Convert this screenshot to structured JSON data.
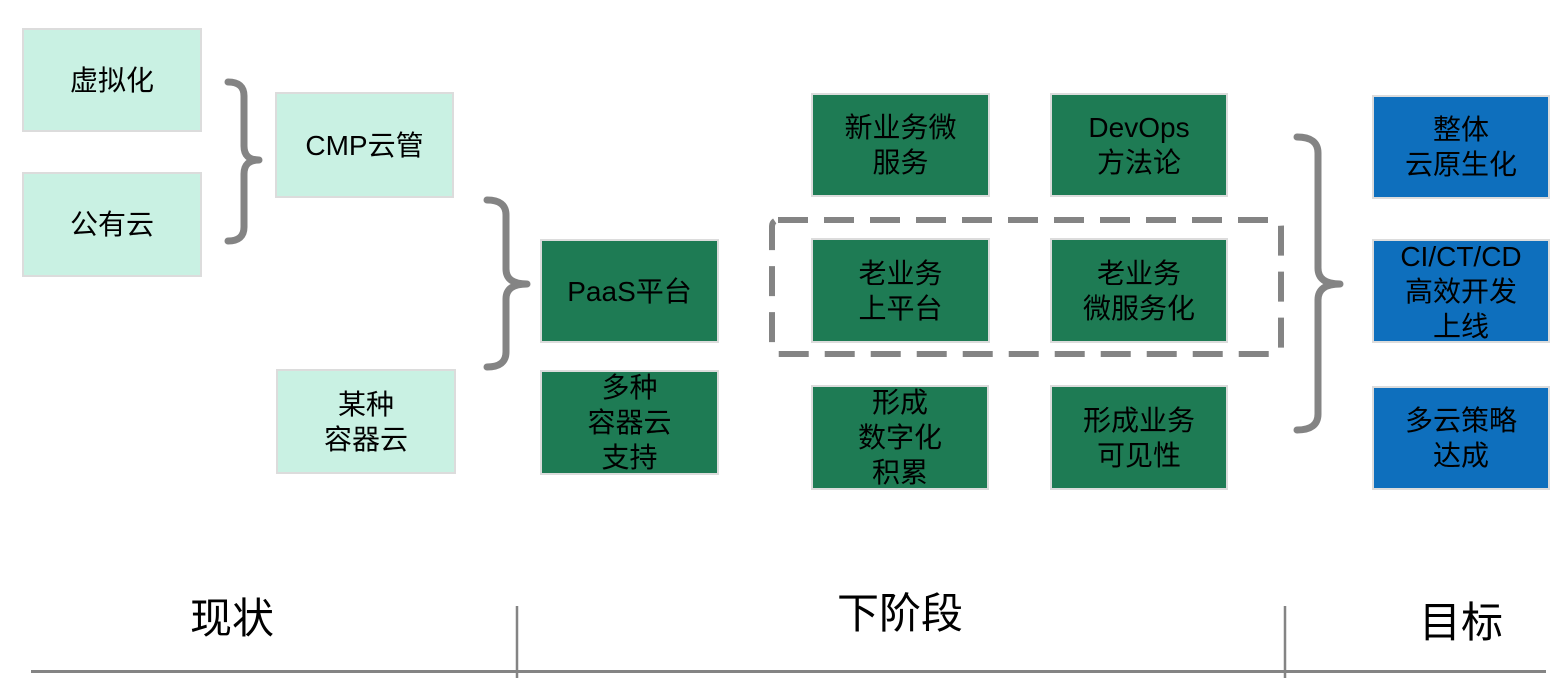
{
  "palette": {
    "mint": "#c9f1e3",
    "green": "#1e7b54",
    "blue": "#0e6fbd",
    "line_gray": "#848484",
    "box_border": "#dcdcdc",
    "text": "#000000"
  },
  "stages": {
    "current": {
      "label": "现状",
      "boxes": {
        "virtualization": "虚拟化",
        "public_cloud": "公有云",
        "cmp": "CMP云管",
        "container_cloud": "某种\n容器云"
      }
    },
    "next": {
      "label": "下阶段",
      "boxes": {
        "paas": "PaaS平台",
        "multi_container": "多种\n容器云\n支持",
        "new_biz_micro": "新业务微\n服务",
        "devops": "DevOps\n方法论",
        "old_biz_platform": "老业务\n上平台",
        "old_biz_micro": "老业务\n微服务化",
        "digital_accum": "形成\n数字化\n积累",
        "biz_visibility": "形成业务\n可见性"
      }
    },
    "goal": {
      "label": "目标",
      "boxes": {
        "cloud_native": "整体\n云原生化",
        "cicd": "CI/CT/CD\n高效开发\n上线",
        "multicloud": "多云策略\n达成"
      }
    }
  }
}
